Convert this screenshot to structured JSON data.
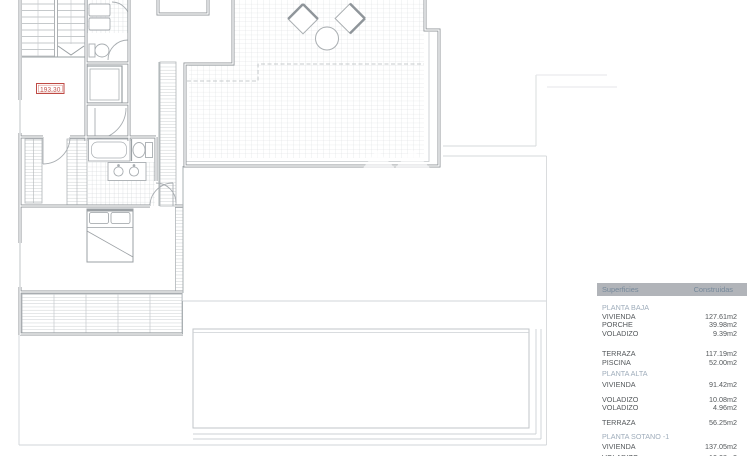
{
  "plan": {
    "elevation_label": "193.30"
  },
  "table": {
    "col_headers": [
      "Superficies",
      "Construidas"
    ],
    "rows": [
      {
        "type": "section",
        "label": "PLANTA BAJA",
        "mt": 8
      },
      {
        "type": "item",
        "label": "VIVIENDA",
        "value": "127.61m2",
        "mt": 0
      },
      {
        "type": "item",
        "label": "PORCHE",
        "value": "39.98m2",
        "mt": 0
      },
      {
        "type": "item",
        "label": "VOLADIZO",
        "value": "9.39m2",
        "mt": 0
      },
      {
        "type": "item",
        "label": "TERRAZA",
        "value": "117.19m2",
        "mt": 12
      },
      {
        "type": "item",
        "label": "PISCINA",
        "value": "52.00m2",
        "mt": 0
      },
      {
        "type": "section",
        "label": "PLANTA ALTA",
        "mt": 3
      },
      {
        "type": "item",
        "label": "VIVIENDA",
        "value": "91.42m2",
        "mt": 2
      },
      {
        "type": "item",
        "label": "VOLADIZO",
        "value": "10.08m2",
        "mt": 6.5
      },
      {
        "type": "item",
        "label": "VOLADIZO",
        "value": "4.96m2",
        "mt": 0
      },
      {
        "type": "item",
        "label": "TERRAZA",
        "value": "56.25m2",
        "mt": 6.5
      },
      {
        "type": "section",
        "label": "PLANTA SOTANO -1",
        "mt": 5
      },
      {
        "type": "item",
        "label": "VIVIENDA",
        "value": "137.05m2",
        "mt": 1.5
      },
      {
        "type": "item",
        "label": "VOLADIZO",
        "value": "10.08m2",
        "mt": 2.5
      }
    ]
  },
  "colors": {
    "dimension_red": "#bf4a45",
    "table_header_bg": "#b1b4b9",
    "table_header_text": "#76899b",
    "table_section_text": "#9fadbb",
    "table_body_text": "#54585b",
    "wall_gray": "#90969a",
    "hatch_gray": "#d9dcdf"
  }
}
